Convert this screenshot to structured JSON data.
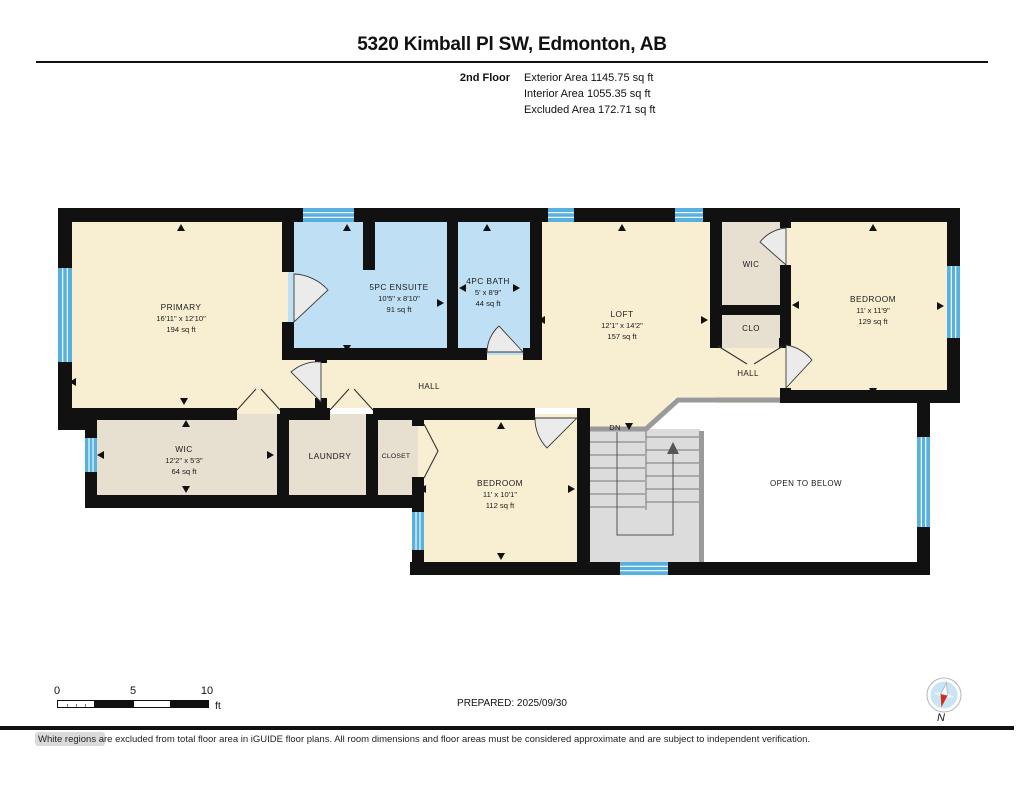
{
  "header": {
    "title": "5320 Kimball Pl SW, Edmonton, AB",
    "floor_label": "2nd Floor",
    "exterior_area": "Exterior Area 1145.75 sq ft",
    "interior_area": "Interior Area 1055.35 sq ft",
    "excluded_area": "Excluded Area 172.71 sq ft"
  },
  "plan": {
    "rooms": {
      "primary": {
        "name": "PRIMARY",
        "dims": "16'11\" x 12'10\"",
        "area": "194 sq ft"
      },
      "ensuite": {
        "name": "5PC ENSUITE",
        "dims": "10'5\" x 8'10\"",
        "area": "91 sq ft"
      },
      "bath": {
        "name": "4PC BATH",
        "dims": "5' x 8'9\"",
        "area": "44 sq ft"
      },
      "loft": {
        "name": "LOFT",
        "dims": "12'1\" x 14'2\"",
        "area": "157 sq ft"
      },
      "wic_right": {
        "name": "WIC"
      },
      "clo": {
        "name": "CLO"
      },
      "hall_right": {
        "name": "HALL"
      },
      "hall": {
        "name": "HALL"
      },
      "bedroom_right": {
        "name": "BEDROOM",
        "dims": "11' x 11'9\"",
        "area": "129 sq ft"
      },
      "wic_left": {
        "name": "WIC",
        "dims": "12'2\" x 5'3\"",
        "area": "64 sq ft"
      },
      "laundry": {
        "name": "LAUNDRY"
      },
      "closet": {
        "name": "CLOSET"
      },
      "bedroom_bottom": {
        "name": "BEDROOM",
        "dims": "11' x 10'1\"",
        "area": "112 sq ft"
      },
      "open_below": {
        "name": "OPEN TO BELOW"
      },
      "stairs_dn": {
        "name": "DN"
      }
    },
    "colors": {
      "room_fill": "#f8efd2",
      "bath_fill": "#bfe0f4",
      "closet_fill": "#e7e0d1",
      "stairs_fill": "#dcdcdc",
      "open_fill": "#ffffff",
      "window_blue": "#58b1dd",
      "wall": "#111111",
      "railing": "#9a9a9a"
    }
  },
  "footer": {
    "scale": {
      "t0": "0",
      "t5": "5",
      "t10": "10",
      "unit": "ft"
    },
    "prepared": "PREPARED: 2025/09/30",
    "compass_label": "N",
    "disclaimer": "White regions are excluded from total floor area in iGUIDE floor plans. All room dimensions and floor areas must be considered approximate and are subject to independent verification."
  }
}
